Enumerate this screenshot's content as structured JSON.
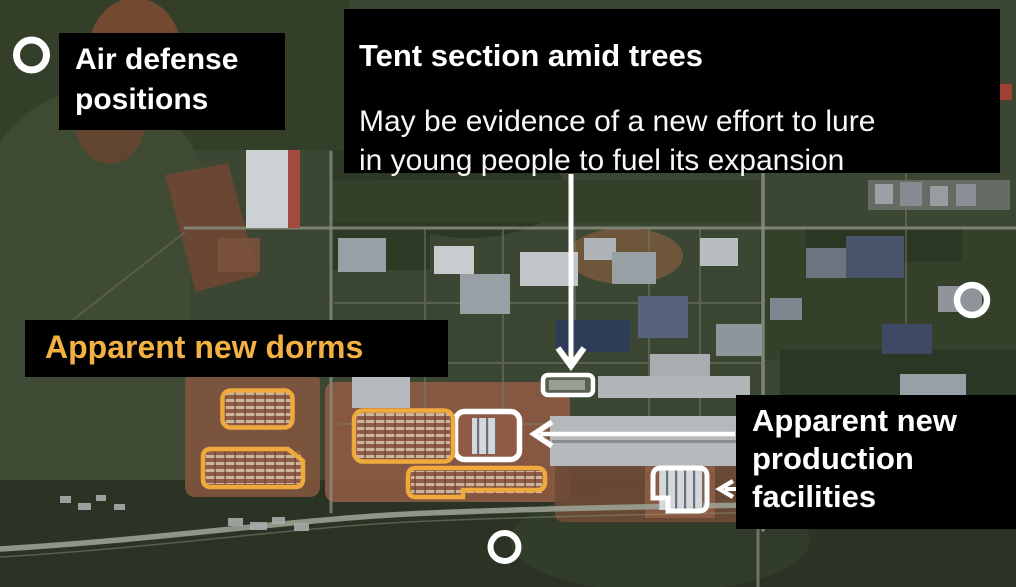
{
  "callouts": {
    "air_defense": {
      "label": "Air defense\npositions"
    },
    "tent": {
      "title": "Tent section amid trees",
      "body": "May be evidence of a new effort to lure\nin young people to fuel its expansion"
    },
    "dorms": {
      "label": "Apparent new dorms"
    },
    "production": {
      "label": "Apparent new\nproduction\nfacilities"
    }
  },
  "colors": {
    "panel_black": "#000000",
    "label_white": "#ffffff",
    "accent_orange": "#F2B142",
    "outline_orange": "#EFA93C",
    "marker_white": "#FFFFFF"
  },
  "markers": {
    "air_defense_ring_count": 3,
    "dorm_outline_count": 4,
    "production_outline_count": 2,
    "tent_outline_count": 1
  }
}
